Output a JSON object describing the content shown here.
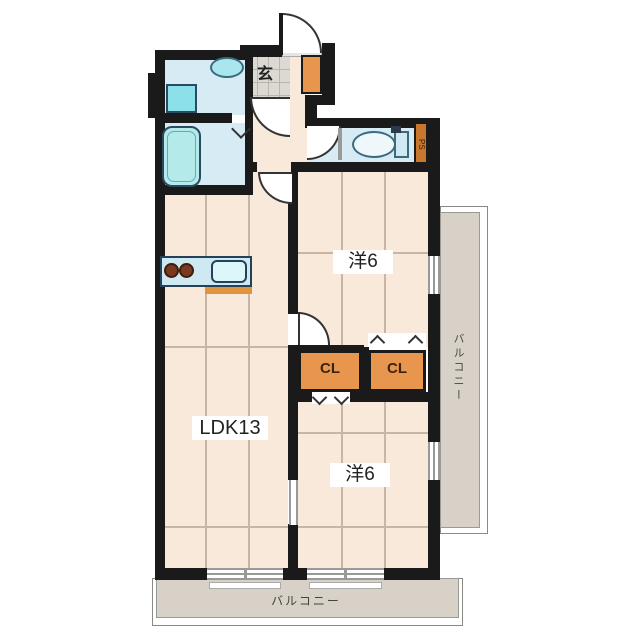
{
  "title": "apartment-floor-plan",
  "labels": {
    "entrance": "玄",
    "bedroom_upper": "洋6",
    "bedroom_lower": "洋6",
    "living": "LDK13",
    "closet_left": "CL",
    "closet_right": "CL",
    "balcony_right": "バルコニー",
    "balcony_bottom": "バルコニー",
    "pipe_space": "PS"
  },
  "colors": {
    "wall": "#1a1a1a",
    "room_floor": "#f9e9da",
    "wet_floor": "#d6ebf3",
    "fixture_cyan": "#8ce0ea",
    "bathtub": "#b4eaea",
    "closet_orange": "#e8954e",
    "pipe_space_orange": "#c9772e",
    "balcony_fill": "#d8d1c7",
    "floor_line": "#c9b5a5",
    "entry_tile": "#dcd8d2",
    "background": "#ffffff"
  }
}
